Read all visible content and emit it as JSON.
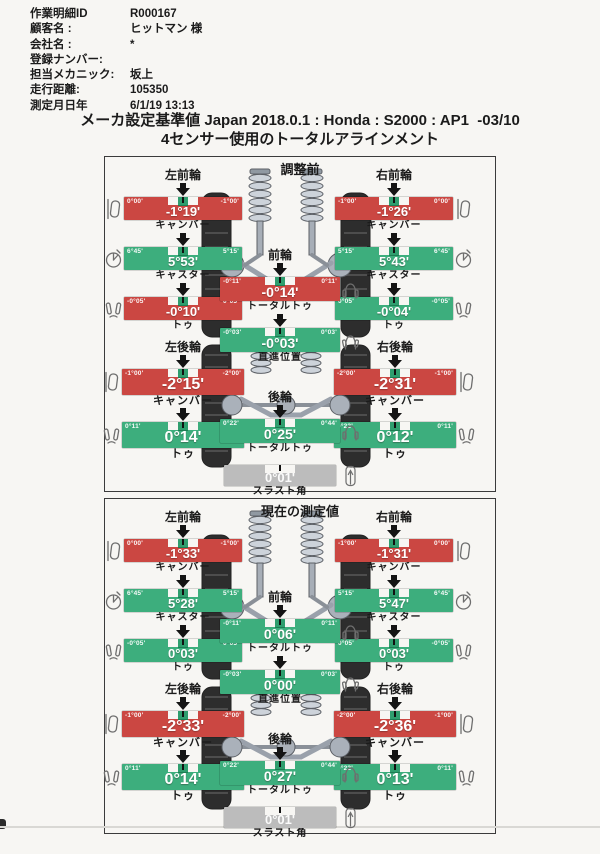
{
  "document": {
    "meta": [
      {
        "label": "作業明細ID",
        "value": "R000167"
      },
      {
        "label": "顧客名 :",
        "value": "ヒットマン 様"
      },
      {
        "label": "会社名 :",
        "value": "*"
      },
      {
        "label": "登録ナンバー:",
        "value": ""
      },
      {
        "label": "担当メカニック:",
        "value": "坂上"
      },
      {
        "label": "走行距離:",
        "value": "105350"
      },
      {
        "label": "測定月日年",
        "value": "6/1/19 13:13"
      }
    ],
    "title": "メーカ設定基準値 Japan 2018.0.1 : Honda : S2000 : AP1  -03/10",
    "subtitle": "4センサー使用のトータルアラインメント"
  },
  "colors": {
    "in_spec_green": "#3dae7d",
    "out_of_spec_red": "#cb4742",
    "neutral_gray": "#bcbcbc",
    "target_marker_green": "#2f9e6e",
    "paper": "#f7f6f3"
  },
  "icons": {
    "camber": "camber-icon",
    "caster": "caster-icon",
    "toe": "toe-icon",
    "total_toe": "car-top-icon",
    "straight": "car-steer-icon",
    "thrust": "thrust-car-icon",
    "pointer": "down-arrow-icon"
  },
  "sections": [
    {
      "title": "調整前",
      "wheels": {
        "lf": {
          "label": "左前輪",
          "measures": {
            "camber": {
              "name": "キャンバー",
              "value": "-1°19'",
              "left": "0°00'",
              "right": "-1°00'",
              "status": "out"
            },
            "caster": {
              "name": "キャスター",
              "value": "5°53'",
              "left": "6°45'",
              "right": "5°15'",
              "status": "ok"
            },
            "toe": {
              "name": "トゥ",
              "value": "-0°10'",
              "left": "-0°05'",
              "right": "0°05'",
              "status": "out"
            }
          }
        },
        "rf": {
          "label": "右前輪",
          "measures": {
            "camber": {
              "name": "キャンバー",
              "value": "-1°26'",
              "left": "-1°00'",
              "right": "0°00'",
              "status": "out"
            },
            "caster": {
              "name": "キャスター",
              "value": "5°43'",
              "left": "5°15'",
              "right": "6°45'",
              "status": "ok"
            },
            "toe": {
              "name": "トゥ",
              "value": "-0°04'",
              "left": "0°05'",
              "right": "-0°05'",
              "status": "ok"
            }
          }
        },
        "front_center": {
          "label": "前輪",
          "measures": {
            "total_toe": {
              "name": "トータルトゥ",
              "value": "-0°14'",
              "left": "-0°11'",
              "right": "0°11'",
              "status": "out"
            },
            "straight": {
              "name": "直進位置",
              "value": "-0°03'",
              "left": "-0°03'",
              "right": "0°03'",
              "status": "ok"
            }
          }
        },
        "lr": {
          "label": "左後輪",
          "measures": {
            "camber": {
              "name": "キャンバー",
              "value": "-2°15'",
              "left": "-1°00'",
              "right": "-2°00'",
              "status": "out"
            },
            "toe": {
              "name": "トゥ",
              "value": "0°14'",
              "left": "0°11'",
              "right": "0°22'",
              "status": "ok"
            }
          }
        },
        "rr": {
          "label": "右後輪",
          "measures": {
            "camber": {
              "name": "キャンバー",
              "value": "-2°31'",
              "left": "-2°00'",
              "right": "-1°00'",
              "status": "out"
            },
            "toe": {
              "name": "トゥ",
              "value": "0°12'",
              "left": "0°22'",
              "right": "0°11'",
              "status": "ok"
            }
          }
        },
        "rear_center": {
          "label": "後輪",
          "measures": {
            "total_toe": {
              "name": "トータルトゥ",
              "value": "0°25'",
              "left": "0°22'",
              "right": "0°44'",
              "status": "ok"
            },
            "thrust": {
              "name": "スラスト角",
              "value": "0°01'",
              "left": "",
              "right": "",
              "status": "neutral"
            }
          }
        }
      }
    },
    {
      "title": "現在の測定値",
      "wheels": {
        "lf": {
          "label": "左前輪",
          "measures": {
            "camber": {
              "name": "キャンバー",
              "value": "-1°33'",
              "left": "0°00'",
              "right": "-1°00'",
              "status": "out"
            },
            "caster": {
              "name": "キャスター",
              "value": "5°28'",
              "left": "6°45'",
              "right": "5°15'",
              "status": "ok"
            },
            "toe": {
              "name": "トゥ",
              "value": "0°03'",
              "left": "-0°05'",
              "right": "0°05'",
              "status": "ok"
            }
          }
        },
        "rf": {
          "label": "右前輪",
          "measures": {
            "camber": {
              "name": "キャンバー",
              "value": "-1°31'",
              "left": "-1°00'",
              "right": "0°00'",
              "status": "out"
            },
            "caster": {
              "name": "キャスター",
              "value": "5°47'",
              "left": "5°15'",
              "right": "6°45'",
              "status": "ok"
            },
            "toe": {
              "name": "トゥ",
              "value": "0°03'",
              "left": "0°05'",
              "right": "-0°05'",
              "status": "ok"
            }
          }
        },
        "front_center": {
          "label": "前輪",
          "measures": {
            "total_toe": {
              "name": "トータルトゥ",
              "value": "0°06'",
              "left": "-0°11'",
              "right": "0°11'",
              "status": "ok"
            },
            "straight": {
              "name": "直進位置",
              "value": "0°00'",
              "left": "-0°03'",
              "right": "0°03'",
              "status": "ok"
            }
          }
        },
        "lr": {
          "label": "左後輪",
          "measures": {
            "camber": {
              "name": "キャンバー",
              "value": "-2°33'",
              "left": "-1°00'",
              "right": "-2°00'",
              "status": "out"
            },
            "toe": {
              "name": "トゥ",
              "value": "0°14'",
              "left": "0°11'",
              "right": "0°22'",
              "status": "ok"
            }
          }
        },
        "rr": {
          "label": "右後輪",
          "measures": {
            "camber": {
              "name": "キャンバー",
              "value": "-2°36'",
              "left": "-2°00'",
              "right": "-1°00'",
              "status": "out"
            },
            "toe": {
              "name": "トゥ",
              "value": "0°13'",
              "left": "0°22'",
              "right": "0°11'",
              "status": "ok"
            }
          }
        },
        "rear_center": {
          "label": "後輪",
          "measures": {
            "total_toe": {
              "name": "トータルトゥ",
              "value": "0°27'",
              "left": "0°22'",
              "right": "0°44'",
              "status": "ok"
            },
            "thrust": {
              "name": "スラスト角",
              "value": "0°01'",
              "left": "",
              "right": "",
              "status": "neutral"
            }
          }
        }
      }
    }
  ]
}
